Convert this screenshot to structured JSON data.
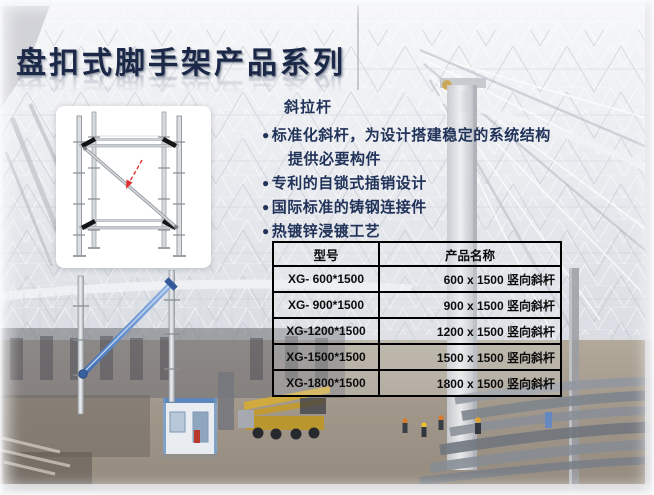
{
  "slide": {
    "title": "盘扣式脚手架产品系列",
    "section_label": "斜拉杆",
    "bullet_glyph": "●",
    "features": [
      {
        "text": "标准化斜杆，为设计搭建稳定的系统结构",
        "cont": "提供必要构件"
      },
      {
        "text": "专利的自锁式插销设计"
      },
      {
        "text": "国际标准的铸钢连接件"
      },
      {
        "text": "热镀锌浸镀工艺"
      }
    ],
    "table": {
      "headers": [
        "型号",
        "产品名称"
      ],
      "rows": [
        [
          "XG- 600*1500",
          "600 x 1500 竖向斜杆"
        ],
        [
          "XG- 900*1500",
          "900 x 1500 竖向斜杆"
        ],
        [
          "XG-1200*1500",
          "1200 x 1500 竖向斜杆"
        ],
        [
          "XG-1500*1500",
          "1500 x 1500 竖向斜杆"
        ],
        [
          "XG-1800*1500",
          "1800 x 1500 竖向斜杆"
        ]
      ]
    },
    "colors": {
      "title_text": "#1b2848",
      "body_text": "#22335a",
      "table_text": "#0c0c0c",
      "table_border": "#000000",
      "brace_blue": "#4a7ac0",
      "arrow_red": "#e03131",
      "crane_yellow": "#d3ab39"
    }
  }
}
